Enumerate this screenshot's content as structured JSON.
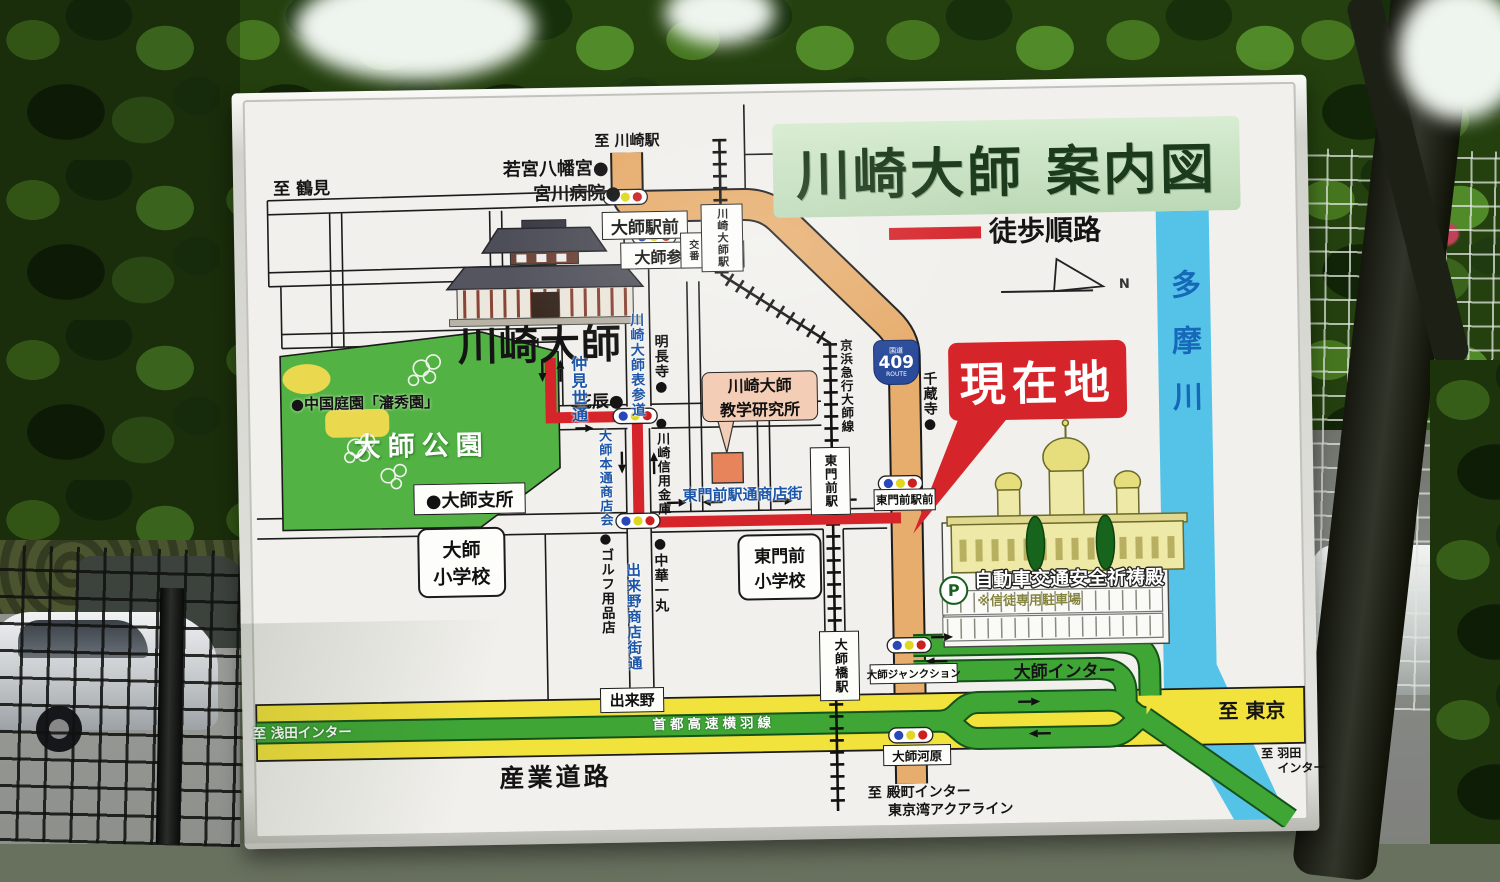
{
  "colors": {
    "route_red": "#d6242b",
    "road_orange": "#e7ad6d",
    "park_green": "#52b244",
    "highway_green": "#3fa636",
    "road_yellow": "#f2e23c",
    "river_blue": "#55c3e8",
    "street_blue": "#1d56a8",
    "title_bg": "#cfe8cb",
    "title_text": "#1c3a1c"
  },
  "sign": {
    "title": "川崎大師 案内図",
    "legend_walk": "徒歩順路",
    "compass": "N",
    "river": "多摩川",
    "here": "現在地",
    "route409": {
      "top": "国道",
      "num": "409",
      "bottom": "ROUTE"
    },
    "dirs": {
      "tsurumi": "至 鶴見",
      "kawasaki_sta": "至 川崎駅",
      "tokyo": "至 東京",
      "asada": "至 浅田インター",
      "tonomachi": "至 殿町インター",
      "aqualine": "東京湾アクアライン",
      "haneda1": "至 羽田",
      "haneda2": "インター"
    },
    "places": {
      "wakamiya": "若宮八幡宮●",
      "miyakawa": "宮川病院●",
      "temple": "川崎大師",
      "myochoji": "明長寺●",
      "hanatatsu": "花辰●",
      "shinkin": "●川崎信用金庫",
      "senzoji": "千蔵寺●",
      "garden": "●中国庭園「瀋秀園」",
      "park": "大師公園",
      "shisho": "●大師支所",
      "golf": "●ゴルフ用品店",
      "chuka": "●中華一丸",
      "daishi_elem1": "大師",
      "daishi_elem2": "小学校",
      "tomon_elem1": "東門前",
      "tomon_elem2": "小学校",
      "kenkyujo1": "川崎大師",
      "kenkyujo2": "教学研究所",
      "kitoden": "自動車交通安全祈祷殿",
      "parking_p": "P",
      "parking_note": "※信徒専用駐車場"
    },
    "streets": {
      "nakamise": "仲見世通",
      "omotesando": "川崎大師表参道",
      "hondori": "大師本通商店会",
      "dekino_st": "出来野商店街通",
      "tomon_st": "東門前駅通商店街",
      "keihin": "京浜急行大師線",
      "shuto": "首都高速横羽線",
      "sangyo": "産業道路",
      "daishi_inter": "大師インター",
      "junction": "大師ジャンクション"
    },
    "boxes": {
      "daishi_ekimae": "大師駅前",
      "sando_iri": "大師参道入口",
      "koban": "交番",
      "kd_sta": "川崎大師駅",
      "tomon_sta": "東門前駅",
      "tomon_ekimae": "東門前駅前",
      "daishibashi_sta": "大師橋駅",
      "dekino": "出来野",
      "kawara": "大師河原"
    }
  }
}
